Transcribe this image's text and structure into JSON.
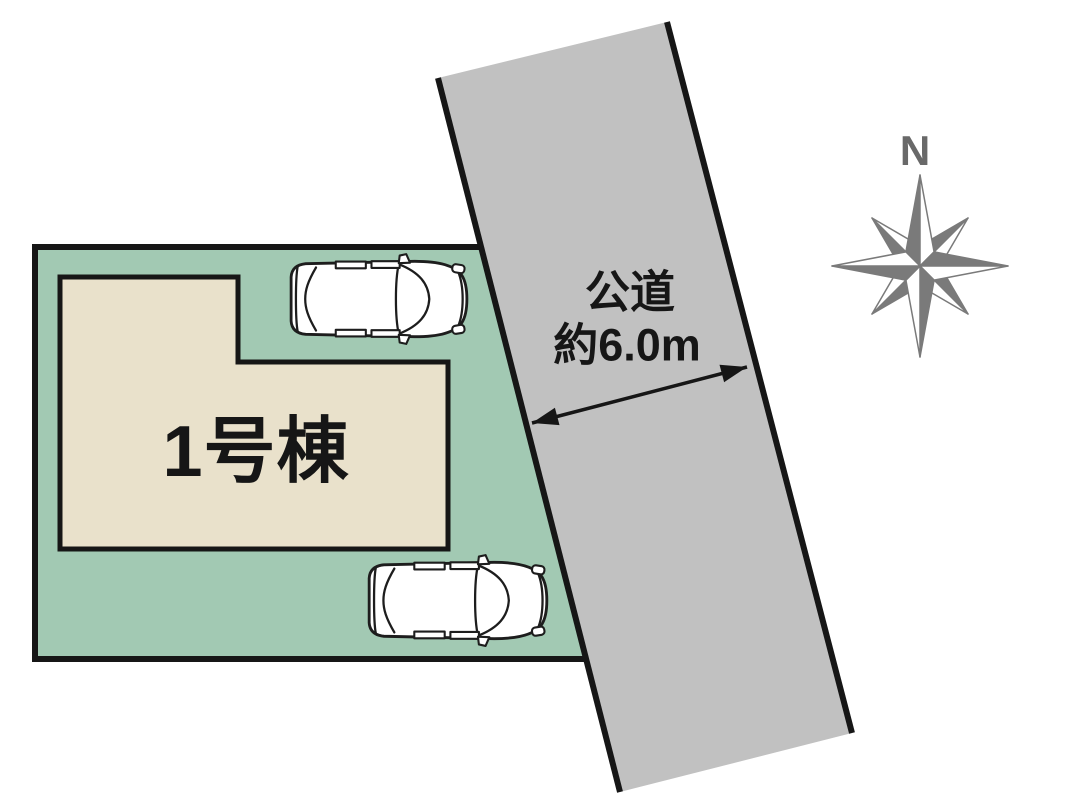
{
  "diagram": {
    "building_label": "1号棟",
    "road_label": "公道",
    "road_width_label": "約6.0m",
    "compass_north_label": "N"
  },
  "colors": {
    "background": "#ffffff",
    "plot_green": "#a2c9b3",
    "building_fill": "#e9e1cb",
    "road_gray": "#c1c1c1",
    "line_black": "#161616",
    "car_white": "#ffffff",
    "compass_gray": "#7a7a7a",
    "compass_letter_gray": "#696969"
  },
  "icons": {
    "compass": "compass-rose-icon",
    "car_top": "car-top-view-icon",
    "car_bottom": "car-top-view-icon",
    "road_width_arrow": "double-headed-arrow-icon"
  }
}
